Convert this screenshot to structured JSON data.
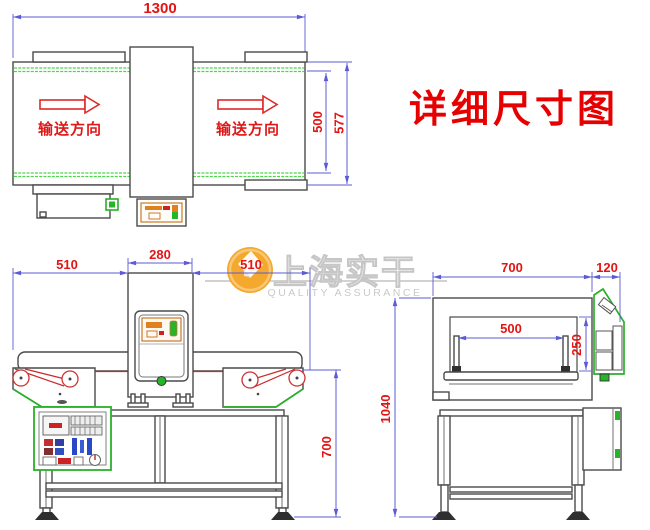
{
  "title": "详细尺寸图",
  "watermark": {
    "brand": "上海实干",
    "tagline": "QUALITY ASSURANCE"
  },
  "top_view": {
    "dim_length": "1300",
    "dim_belt_width": "500",
    "dim_overall_width": "577",
    "direction_left": "输送方向",
    "direction_right": "输送方向"
  },
  "front_view": {
    "dim_left": "510",
    "dim_detector": "280",
    "dim_right": "510",
    "dim_belt_height": "700"
  },
  "side_view": {
    "dim_body_width": "700",
    "dim_panel": "120",
    "dim_aperture_width": "500",
    "dim_aperture_height": "250",
    "dim_total_height": "1040"
  },
  "colors": {
    "dimension_blue": "#5b5bd6",
    "label_red": "#e41414",
    "machine_outline": "#4a4a4a",
    "belt_green": "#4ed44e",
    "panel_green": "#2ab02a",
    "accent_orange": "#e0801e",
    "watermark_orange": "#f5a82e",
    "watermark_gray": "#c9c9c9"
  }
}
